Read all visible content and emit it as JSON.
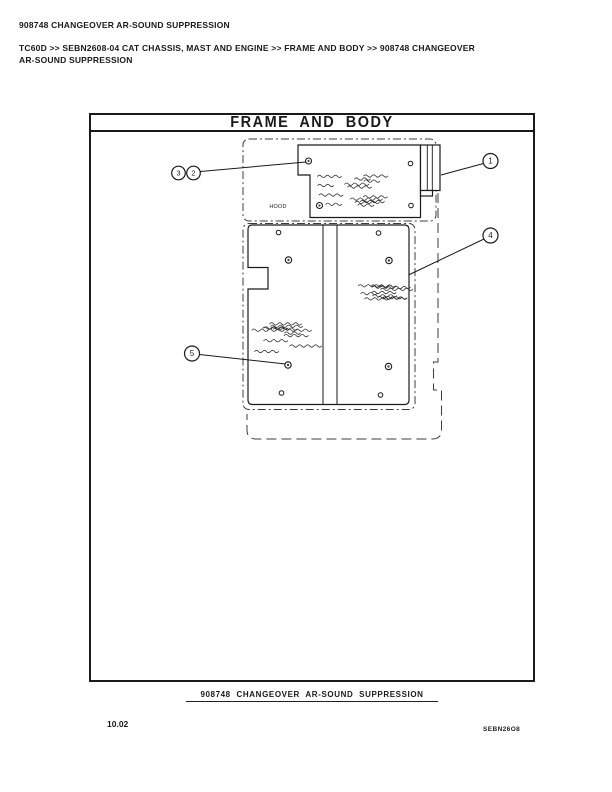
{
  "colors": {
    "ink": "#1a1a1a"
  },
  "page": {
    "header_title": "908748 CHANGEOVER AR-SOUND SUPPRESSION",
    "breadcrumb": "TC60D >> SEBN2608-04 CAT CHASSIS, MAST AND ENGINE >> FRAME AND BODY >> 908748 CHANGEOVER AR-SOUND SUPPRESSION",
    "page_number": "10.02",
    "doc_code": "SEBN26O8"
  },
  "diagram": {
    "title": "FRAME AND BODY",
    "caption": "908748 CHANGEOVER AR-SOUND SUPPRESSION",
    "hood_label": "HOOD",
    "callouts": [
      {
        "label": "3"
      },
      {
        "label": "2"
      },
      {
        "label": "1"
      },
      {
        "label": "4"
      },
      {
        "label": "5"
      }
    ]
  }
}
